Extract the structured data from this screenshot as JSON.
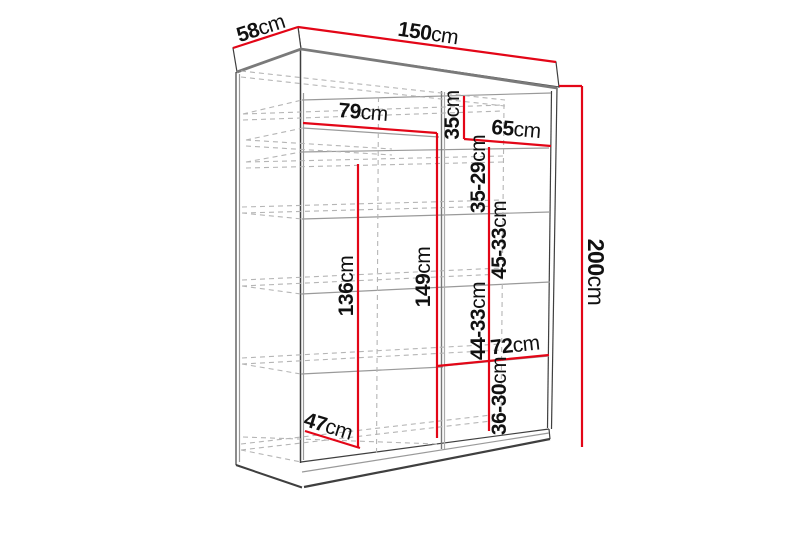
{
  "diagram_title": "Wardrobe dimension diagram",
  "dimensions": {
    "width": {
      "value": "150",
      "unit": "cm"
    },
    "depth": {
      "value": "58",
      "unit": "cm"
    },
    "height": {
      "value": "200",
      "unit": "cm"
    },
    "left_shelf_width": {
      "value": "79",
      "unit": "cm"
    },
    "right_top_gap": {
      "value": "35",
      "unit": "cm"
    },
    "right_shelf_width": {
      "value": "65",
      "unit": "cm"
    },
    "right_gap_1": {
      "value": "35-29",
      "unit": "cm"
    },
    "right_gap_2": {
      "value": "45-33",
      "unit": "cm"
    },
    "left_hanging_height": {
      "value": "136",
      "unit": "cm"
    },
    "middle_height": {
      "value": "149",
      "unit": "cm"
    },
    "right_gap_3": {
      "value": "44-33",
      "unit": "cm"
    },
    "lower_right_width": {
      "value": "72",
      "unit": "cm"
    },
    "right_gap_4": {
      "value": "36-30",
      "unit": "cm"
    },
    "floor_depth": {
      "value": "47",
      "unit": "cm"
    }
  },
  "colors": {
    "dimension_red": "#e30617",
    "outline_dark": "#3f3f3f",
    "panel_grey": "#7a7a7a",
    "shelf_grey": "#9a9a9a",
    "dashed_grey": "#b5b5b5",
    "label_black": "#111111",
    "background": "#ffffff"
  }
}
